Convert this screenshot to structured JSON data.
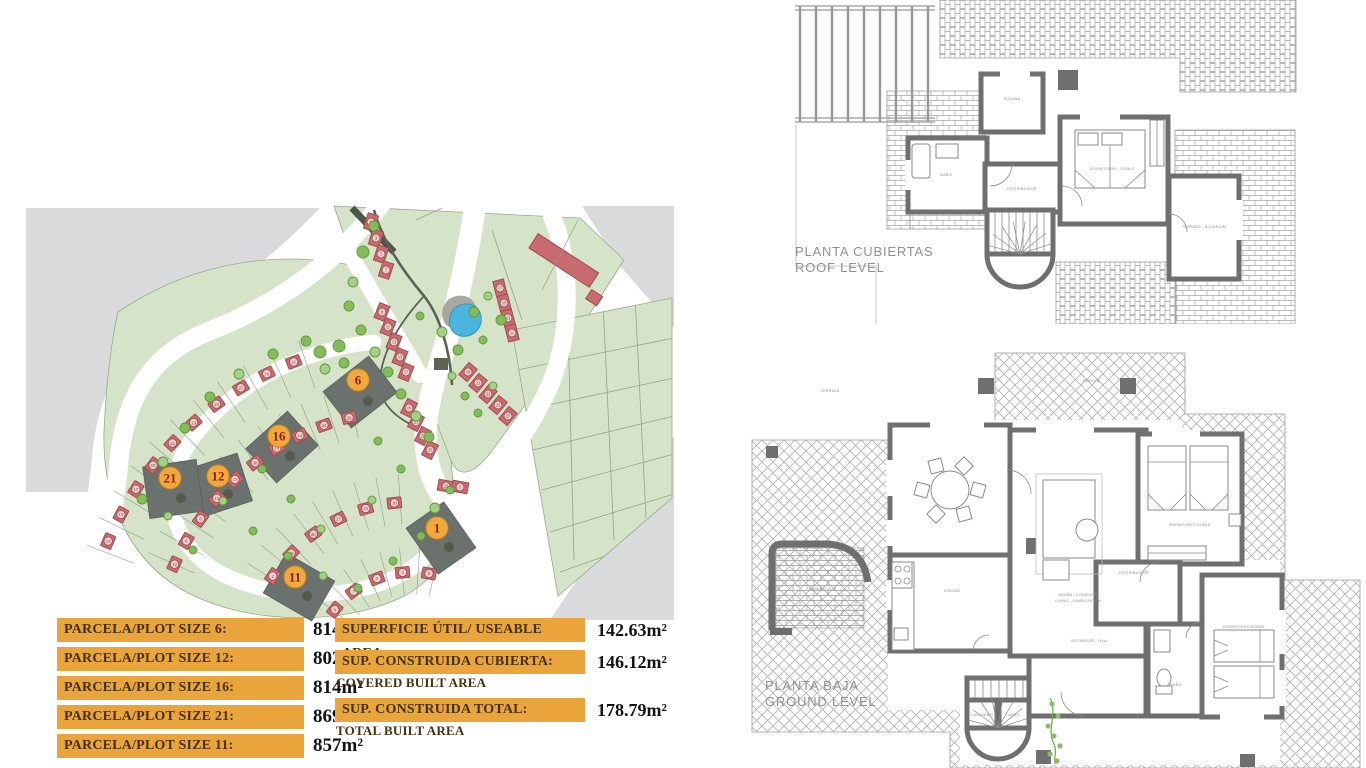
{
  "colors": {
    "bar": "#e9a43c",
    "bar_text": "#45310f",
    "value_text": "#131313",
    "badge": "#f2a93b",
    "badge_edge": "#cf8b22",
    "badge_text": "#8a1f1f",
    "house": "#c96a6e",
    "house_edge": "#9c4b4f",
    "unit_circle": "#eedcd6",
    "green": "#d5e3c8",
    "green_edge": "#9aa88f",
    "gray": "#d9dadb",
    "dark_plot": "#6b716c",
    "dark_plot_edge": "#596058",
    "plot_tree": "#525c4c",
    "tree": "#84bc5c",
    "tree_edge": "#61973d",
    "pool": "#4ab5dd",
    "park_path": "#5c6156",
    "wall": "#6f6f6f",
    "plan_text": "#8f9193"
  },
  "tables": {
    "plots": {
      "rows": [
        {
          "label": "PARCELA/PLOT SIZE 6:",
          "value": "814m²"
        },
        {
          "label": "PARCELA/PLOT SIZE 12:",
          "value": "802m²"
        },
        {
          "label": "PARCELA/PLOT SIZE 16:",
          "value": "814m²"
        },
        {
          "label": "PARCELA/PLOT SIZE 21:",
          "value": "869m²"
        },
        {
          "label": "PARCELA/PLOT SIZE 11:",
          "value": "857m²"
        }
      ]
    },
    "areas": {
      "rows": [
        {
          "label": "SUPERFICIE ÚTIL/ USEABLE AREA:",
          "value": "142.63m²",
          "sub": ""
        },
        {
          "label": "SUP. CONSTRUIDA CUBIERTA:",
          "value": "146.12m²",
          "sub": "COVERED BUILT AREA"
        },
        {
          "label": "SUP. CONSTRUIDA TOTAL:",
          "value": "178.79m²",
          "sub": "TOTAL BUILT AREA"
        }
      ]
    }
  },
  "floorplans": {
    "roof": {
      "title1": "PLANTA CUBIERTAS",
      "title2": "ROOF LEVEL",
      "labels": [
        {
          "t": "SOLANA",
          "x": 252,
          "y": 100
        },
        {
          "t": "BAÑO",
          "x": 186,
          "y": 176
        },
        {
          "t": "DISTRIBUIDOR",
          "x": 262,
          "y": 190
        },
        {
          "t": "DORMITORIO - DOBLE",
          "x": 352,
          "y": 170
        },
        {
          "t": "TERRAZA - SOLARIUM",
          "x": 444,
          "y": 228
        }
      ]
    },
    "ground": {
      "title1": "PLANTA BAJA",
      "title2": "GROUND LEVEL",
      "labels": [
        {
          "t": "PORCHE",
          "x": 352,
          "y": 52
        },
        {
          "t": "TERRAZA",
          "x": 90,
          "y": 62
        },
        {
          "t": "COCINA",
          "x": 212,
          "y": 262
        },
        {
          "t": "SALÓN - COMEDOR",
          "x": 338,
          "y": 266
        },
        {
          "t": "LIVING - DINING ROOM",
          "x": 338,
          "y": 272
        },
        {
          "t": "RECIBIDOR - HALL",
          "x": 350,
          "y": 312
        },
        {
          "t": "DISTRIBUIDOR",
          "x": 394,
          "y": 244
        },
        {
          "t": "DORMITORIO DOBLE",
          "x": 450,
          "y": 196
        },
        {
          "t": "BAÑO",
          "x": 436,
          "y": 356
        },
        {
          "t": "DORMITORIO DOBLE",
          "x": 504,
          "y": 298
        },
        {
          "t": "BARBACOA",
          "x": 80,
          "y": 260
        },
        {
          "t": "LAVADERO",
          "x": 242,
          "y": 386
        },
        {
          "t": "ASEO",
          "x": 274,
          "y": 386
        }
      ]
    }
  },
  "site_plan": {
    "highlight_plots": [
      {
        "n": "6",
        "rx": 338,
        "ry": 192,
        "w": 58,
        "h": 46,
        "rot": -38,
        "bx": 336,
        "by": 180
      },
      {
        "n": "16",
        "rx": 260,
        "ry": 247,
        "w": 56,
        "h": 46,
        "rot": -42,
        "bx": 257,
        "by": 236
      },
      {
        "n": "12",
        "rx": 198,
        "ry": 285,
        "w": 52,
        "h": 50,
        "rot": -18,
        "bx": 196,
        "by": 276
      },
      {
        "n": "21",
        "rx": 151,
        "ry": 289,
        "w": 54,
        "h": 52,
        "rot": -8,
        "bx": 148,
        "by": 278
      },
      {
        "n": "11",
        "rx": 277,
        "ry": 387,
        "w": 56,
        "h": 46,
        "rot": 30,
        "bx": 273,
        "by": 377
      },
      {
        "n": "1",
        "rx": 419,
        "ry": 338,
        "w": 56,
        "h": 46,
        "rot": 55,
        "bx": 415,
        "by": 328
      }
    ],
    "house_arcs": [
      {
        "cx": 390,
        "cy": 470,
        "r": 330,
        "a0": 203,
        "a1": 249,
        "nums": [
          13,
          15,
          17,
          19,
          22,
          23,
          25,
          27,
          19,
          21
        ]
      },
      {
        "cx": 390,
        "cy": 470,
        "r": 260,
        "a0": 204,
        "a1": 256,
        "nums": [
          12,
          8,
          6,
          15,
          13,
          30,
          18,
          14,
          24,
          26
        ]
      },
      {
        "cx": 390,
        "cy": 470,
        "r": 168,
        "a0": 214,
        "a1": 264,
        "nums": [
          2,
          29,
          20,
          27,
          25,
          10
        ]
      },
      {
        "cx": 390,
        "cy": 470,
        "r": 98,
        "a0": 218,
        "a1": 280,
        "nums": [
          9,
          7,
          5,
          3,
          8
        ]
      }
    ],
    "plot_line_bands": [
      {
        "cx": 390,
        "cy": 470,
        "r0": 348,
        "r1": 298,
        "a0": 201,
        "a1": 251,
        "n": 10
      },
      {
        "cx": 390,
        "cy": 470,
        "r0": 288,
        "r1": 238,
        "a0": 204,
        "a1": 257,
        "n": 11
      },
      {
        "cx": 390,
        "cy": 470,
        "r0": 196,
        "r1": 146,
        "a0": 213,
        "a1": 266,
        "n": 8
      },
      {
        "cx": 390,
        "cy": 470,
        "r0": 122,
        "r1": 76,
        "a0": 217,
        "a1": 283,
        "n": 7
      }
    ],
    "townhouse_rows": [
      {
        "x": 349,
        "y": 22,
        "dx": 5,
        "dy": 16,
        "a": 18,
        "nums": [
          1,
          3,
          5,
          7
        ]
      },
      {
        "x": 360,
        "y": 112,
        "dx": 6,
        "dy": 15,
        "a": 22,
        "nums": [
          9,
          11,
          13,
          15,
          17
        ]
      },
      {
        "x": 387,
        "y": 208,
        "dx": 7,
        "dy": 14,
        "a": 27,
        "nums": [
          19,
          21,
          23,
          25
        ]
      },
      {
        "x": 424,
        "y": 286,
        "dx": 14,
        "dy": 1,
        "a": 100,
        "nums": [
          23,
          1
        ]
      },
      {
        "x": 478,
        "y": 88,
        "dx": 4,
        "dy": 15,
        "a": -14,
        "nums": [
          17,
          15,
          13,
          11
        ]
      },
      {
        "x": 446,
        "y": 172,
        "dx": 10,
        "dy": 11,
        "a": 40,
        "nums": [
          19,
          21,
          23,
          25,
          27
        ]
      }
    ],
    "trees": [
      [
        352,
        26,
        5
      ],
      [
        341,
        52,
        6
      ],
      [
        331,
        82,
        5
      ],
      [
        327,
        106,
        5
      ],
      [
        339,
        130,
        5
      ],
      [
        353,
        152,
        5
      ],
      [
        366,
        172,
        5
      ],
      [
        379,
        194,
        5
      ],
      [
        394,
        216,
        5
      ],
      [
        407,
        237,
        5
      ],
      [
        398,
        116,
        4
      ],
      [
        420,
        132,
        5
      ],
      [
        436,
        150,
        5
      ],
      [
        452,
        112,
        5
      ],
      [
        466,
        96,
        4
      ],
      [
        479,
        120,
        5
      ],
      [
        461,
        140,
        4
      ],
      [
        430,
        176,
        4
      ],
      [
        443,
        196,
        4
      ],
      [
        456,
        213,
        4
      ],
      [
        471,
        186,
        4
      ],
      [
        298,
        152,
        6
      ],
      [
        317,
        146,
        6
      ],
      [
        303,
        169,
        5
      ],
      [
        322,
        163,
        5
      ],
      [
        120,
        299,
        5
      ],
      [
        141,
        262,
        5
      ],
      [
        163,
        228,
        5
      ],
      [
        188,
        197,
        5
      ],
      [
        217,
        174,
        5
      ],
      [
        251,
        154,
        5
      ],
      [
        284,
        141,
        5
      ],
      [
        201,
        301,
        4
      ],
      [
        231,
        331,
        4
      ],
      [
        266,
        356,
        4
      ],
      [
        301,
        376,
        4
      ],
      [
        336,
        388,
        4
      ],
      [
        171,
        350,
        4
      ],
      [
        146,
        316,
        4
      ],
      [
        371,
        361,
        4
      ],
      [
        399,
        336,
        4
      ],
      [
        299,
        329,
        4
      ],
      [
        269,
        299,
        4
      ],
      [
        240,
        269,
        4
      ],
      [
        350,
        300,
        4
      ],
      [
        379,
        269,
        4
      ],
      [
        356,
        241,
        4
      ],
      [
        413,
        308,
        5
      ],
      [
        428,
        290,
        4
      ]
    ]
  }
}
